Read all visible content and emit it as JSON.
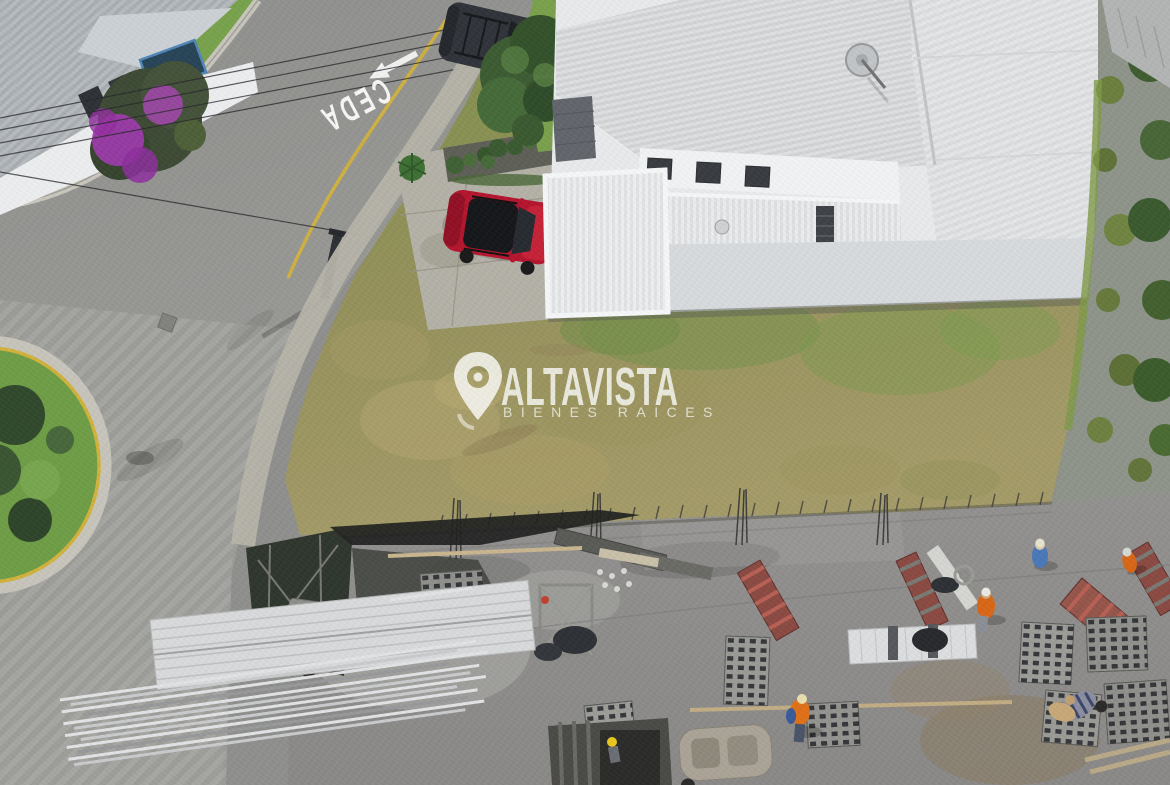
{
  "image": {
    "kind": "aerial-drone-photo",
    "subject": "Aerial view of a vacant residential corner lot between houses, with street intersection at left and an active construction slab at the bottom"
  },
  "watermark": {
    "icon": "location-pin",
    "brand": "ALTAVISTA",
    "tagline": "BIENES RAICES",
    "text_color": "#ffffff"
  },
  "road": {
    "yield_marking_text": "CEDA",
    "arrow_marking": "arrow pointing down-left along lane",
    "marking_color": "#ffffff",
    "edge_line_color": "#d2b23c"
  },
  "scene": {
    "colors": {
      "asphalt": "#90908e",
      "pavers": "#a3a3a0",
      "sidewalk": "#b6b4a9",
      "lot_grass": "#8f9157",
      "lawn_grass": "#78a24c",
      "corner_house_roof": "#b6bbc0",
      "modern_house_white": "#e8eaec",
      "construction_slab": "#8d8c8a",
      "safety_mesh": "#2e362d",
      "bougainvillea": "#a13bb0",
      "red_suv": "#b5152e",
      "dark_suv": "#30343a",
      "yellow_curb": "#d2b23c",
      "stone_wall": "#8e948a",
      "worker_vest_orange": "#d96718",
      "worker_shirt_blue": "#4a78b8"
    },
    "elements": [
      "corner house with gray metal roof and purple bougainvillea",
      "street with CEDA yield marking, lane arrow and yellow edge line",
      "grass traffic island with yellow curb",
      "utility pole with overhead power lines",
      "dark SUV parked on street",
      "red SUV parked on concrete driveway",
      "white modern house with corrugated roof and satellite dish",
      "stone retaining wall with moss along right edge",
      "vacant grass lot in the center",
      "construction site: concrete slab, rebar starter bars",
      "stacks of concrete blocks",
      "stacked white roofing sheets and pipes",
      "red-striped formwork ramps",
      "wheelbarrow, cart and scaffold",
      "workers with orange vests, blue shirt, helmets",
      "dark safety mesh fence"
    ]
  }
}
